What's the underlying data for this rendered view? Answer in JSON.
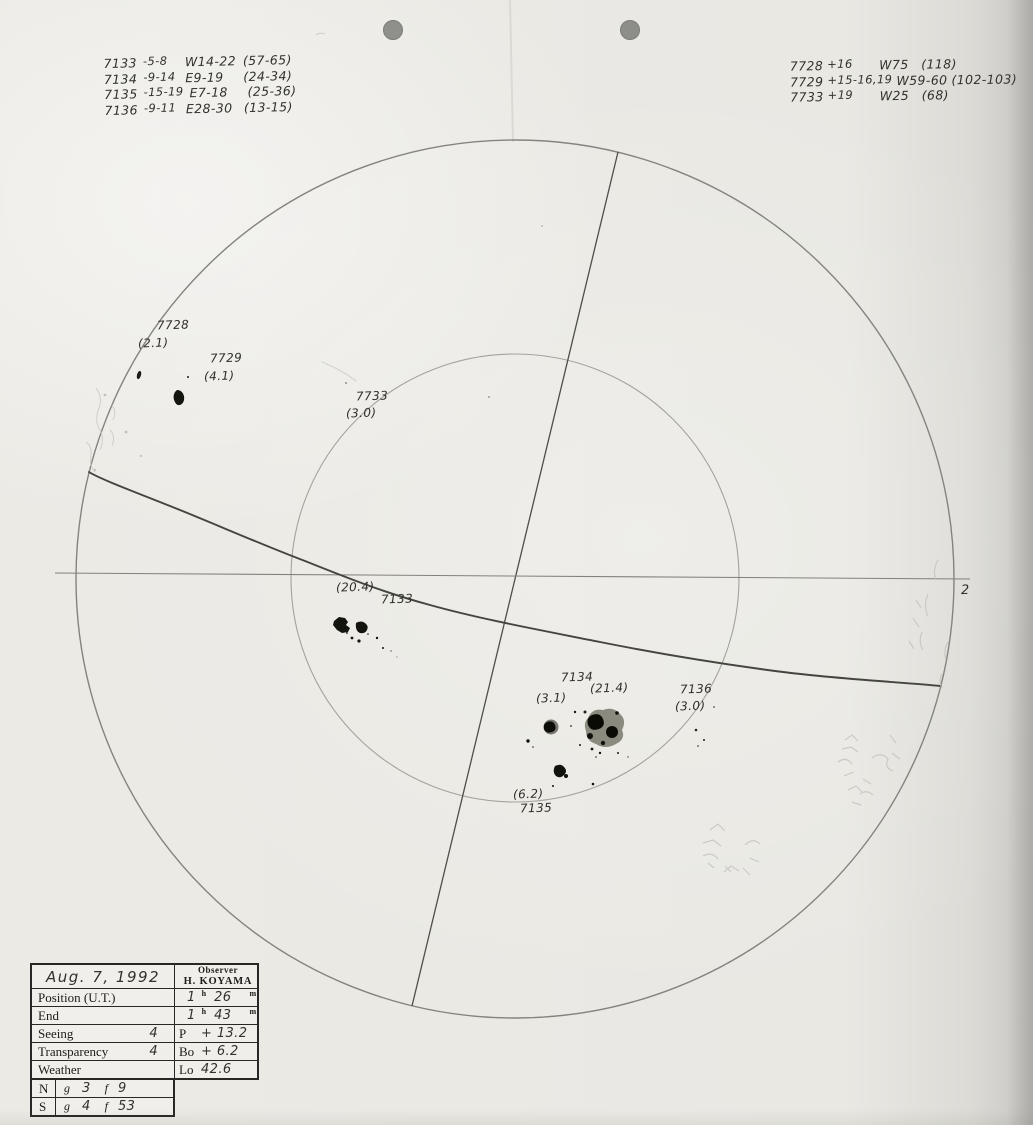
{
  "notes_left": {
    "lines": [
      {
        "group": "7133",
        "lat": "-5-8",
        "lon": "W14-22",
        "range": "(57-65)"
      },
      {
        "group": "7134",
        "lat": "-9-14",
        "lon": "E9-19",
        "range": "(24-34)"
      },
      {
        "group": "7135",
        "lat": "-15-19",
        "lon": "E7-18",
        "range": "(25-36)"
      },
      {
        "group": "7136",
        "lat": "-9-11",
        "lon": "E28-30",
        "range": "(13-15)"
      }
    ]
  },
  "notes_right": {
    "lines": [
      {
        "group": "7728",
        "lat": "+16",
        "lon": "W75",
        "range": "(118)"
      },
      {
        "group": "7729",
        "lat": "+15-16,19",
        "lon": "W59-60",
        "range": "(102-103)"
      },
      {
        "group": "7733",
        "lat": "+19",
        "lon": "W25",
        "range": "(68)"
      }
    ]
  },
  "disk_labels": {
    "g7728": "7728",
    "a7728": "(2.1)",
    "g7729": "7729",
    "a7729": "(4.1)",
    "g7733": "7733",
    "a7733": "(3.0)",
    "a7133": "(20.4)",
    "g7133": "7133",
    "g7134": "7134",
    "a7134": "(21.4)",
    "a7134w": "(3.1)",
    "g7136": "7136",
    "a7136": "(3.0)",
    "a7135": "(6.2)",
    "g7135": "7135",
    "limb": "2"
  },
  "table": {
    "date": "Aug. 7, 1992",
    "observer_label": "Observer",
    "observer_name": "H. KOYAMA",
    "position_label": "Position (U.T.)",
    "position_h": "1",
    "position_m": "26",
    "end_label": "End",
    "end_h": "1",
    "end_m": "43",
    "hour_unit": "h",
    "minute_unit": "m",
    "seeing_label": "Seeing",
    "seeing_value": "4",
    "p_label": "P",
    "p_value": "+ 13.2",
    "transparency_label": "Transparency",
    "transparency_value": "4",
    "bo_label": "Bo",
    "bo_value": "+ 6.2",
    "weather_label": "Weather",
    "lo_label": "Lo",
    "lo_value": "42.6",
    "north_label": "N",
    "north_g_label": "g",
    "north_g": "3",
    "north_f_label": "f",
    "north_f": "9",
    "south_label": "S",
    "south_g_label": "g",
    "south_g": "4",
    "south_f_label": "f",
    "south_f": "53"
  }
}
